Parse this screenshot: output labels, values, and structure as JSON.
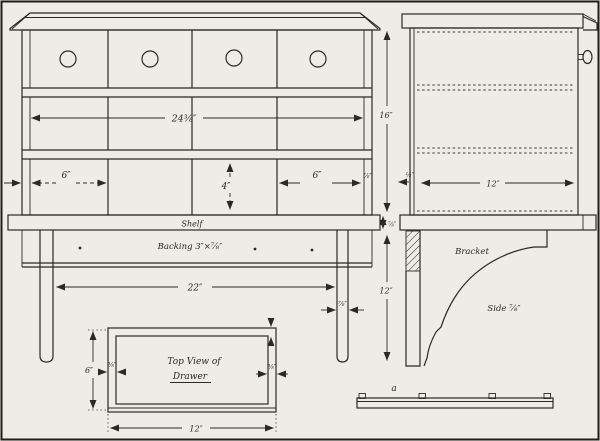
{
  "colors": {
    "paper": "#edece7",
    "ink": "#2a2a24"
  },
  "front_view": {
    "shelf_label": "Shelf",
    "backing_label": "Backing 3″×⅞″",
    "width_dim": "24⅜″",
    "compartment_left_dim": "6″",
    "compartment_mid_dim": "4″",
    "compartment_right_dim": "6″",
    "stile_thickness_dim": "⅞″",
    "bracket_span_dim": "22″",
    "strip_thickness_dim": "⅞″"
  },
  "side_view": {
    "height_dim": "16″",
    "depth_dim": "12″",
    "setback_dim": "½″",
    "shelf_thickness_dim": "⅞″",
    "bracket_height_dim": "12″",
    "bracket_label": "Bracket",
    "side_label": "Side ⅞″",
    "cleat_label": "a"
  },
  "drawer_view": {
    "title_line1": "Top View of",
    "title_line2": "Drawer",
    "height_dim": "6″",
    "width_dim": "12″",
    "side_thickness_left_dim": "⅜″",
    "side_thickness_right_dim": "⅜″"
  }
}
